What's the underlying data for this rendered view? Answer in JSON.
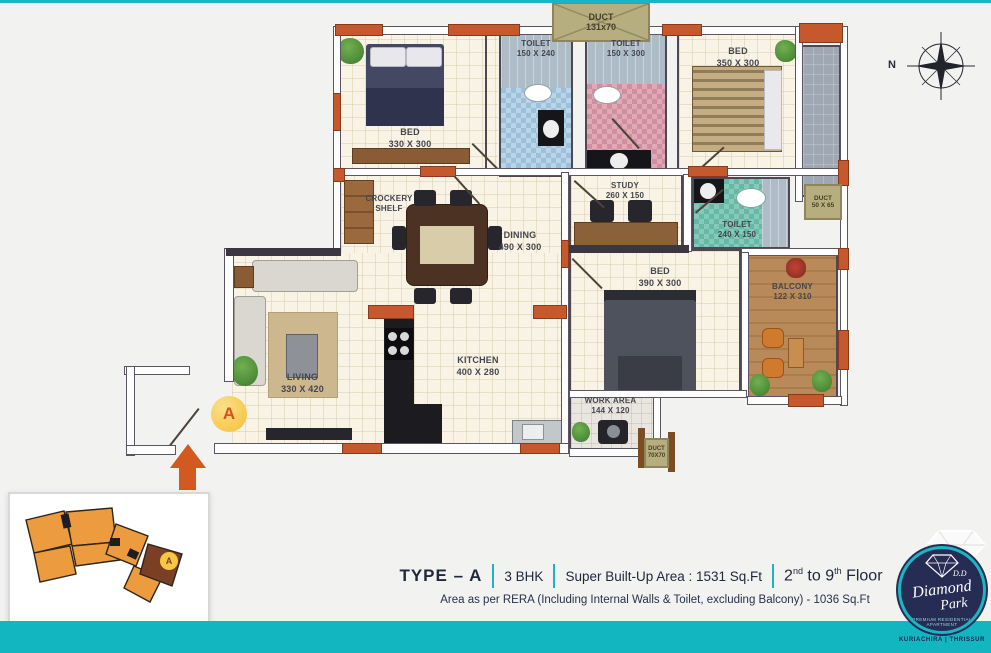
{
  "colors": {
    "teal": "#14b7c2",
    "accent_orange": "#c6582e",
    "navy_text": "#20283c",
    "floor_cream": "#f8f3e5",
    "duct_khaki": "#b7ae80",
    "keyplan_orange": "#ec9c3e",
    "marker_yellow": "#f7c743",
    "logo_navy": "#272c55"
  },
  "plan": {
    "compass_label": "N",
    "entrance_marker": "A",
    "rooms": {
      "duct_top": {
        "line1": "DUCT",
        "line2": "131x70"
      },
      "bed1": {
        "line1": "BED",
        "line2": "330 X 300"
      },
      "toilet1": {
        "line1": "TOILET",
        "line2": "150 X 240"
      },
      "toilet2": {
        "line1": "TOILET",
        "line2": "150 X 300"
      },
      "bed2": {
        "line1": "BED",
        "line2": "350 X 300"
      },
      "duct_right": {
        "line1": "DUCT",
        "line2": "50 X 65"
      },
      "crockery": {
        "line1": "CROCKERY",
        "line2": "SHELF"
      },
      "dining": {
        "line1": "DINING",
        "line2": "490 X 300"
      },
      "study": {
        "line1": "STUDY",
        "line2": "260 X 150"
      },
      "toilet3": {
        "line1": "TOILET",
        "line2": "240 X 150"
      },
      "bed3": {
        "line1": "BED",
        "line2": "390 X 300"
      },
      "balcony": {
        "line1": "BALCONY",
        "line2": "122 X 310"
      },
      "living": {
        "line1": "LIVING",
        "line2": "330 X 420"
      },
      "kitchen": {
        "line1": "KITCHEN",
        "line2": "400 X 280"
      },
      "work_area": {
        "line1": "WORK AREA",
        "line2": "144 X 120"
      },
      "duct_bottom": {
        "line1": "DUCT",
        "line2": "70X70"
      }
    }
  },
  "keyplan": {
    "marker": "A"
  },
  "footer": {
    "type": "TYPE – A",
    "bhk": "3 BHK",
    "area": "Super Built-Up Area : 1531 Sq.Ft",
    "floor_num": "2",
    "floor_sup1": "nd",
    "floor_mid": " to 9",
    "floor_sup2": "th",
    "floor_end": " Floor",
    "rera": "Area as per RERA (Including Internal Walls & Toilet, excluding Balcony) - 1036 Sq.Ft"
  },
  "logo": {
    "dd": "D.D",
    "name_line1": "Diamond",
    "name_line2": "Park",
    "tagline": "PREMIUM RESIDENTIAL APARTMENT",
    "location": "KURIACHIRA | THRISSUR"
  }
}
